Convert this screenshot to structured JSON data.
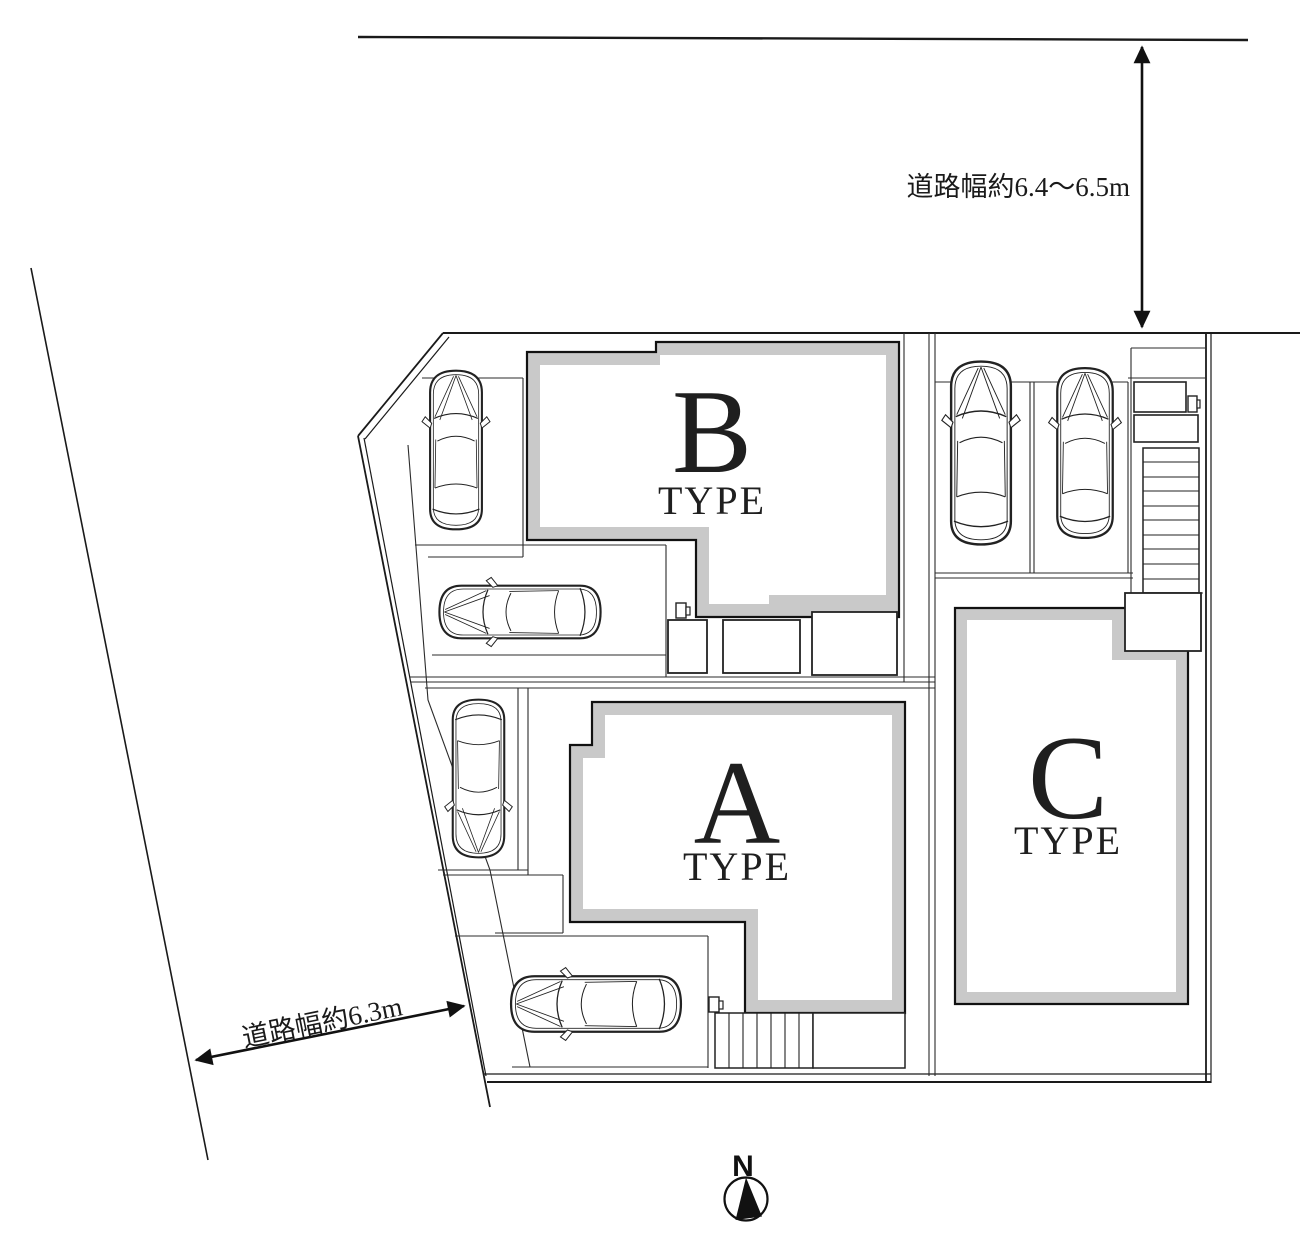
{
  "plan": {
    "building_b": {
      "letter": "B",
      "type_label": "TYPE"
    },
    "building_a": {
      "letter": "A",
      "type_label": "TYPE"
    },
    "building_c": {
      "letter": "C",
      "type_label": "TYPE"
    },
    "road_width_top_label": "道路幅約6.4〜6.5m",
    "road_width_left_label": "道路幅約6.3m",
    "compass_north_label": "N",
    "cars_visible": 6,
    "colors": {
      "building_shadow_gray": "#c9c9c9",
      "drawing_line": "#1a1a1a",
      "background": "#ffffff"
    },
    "icons": {
      "compass": "north-compass-icon",
      "car": "car-top-view-icon",
      "stairs": "stairs-treads",
      "meter": "meter-box-icon"
    }
  }
}
